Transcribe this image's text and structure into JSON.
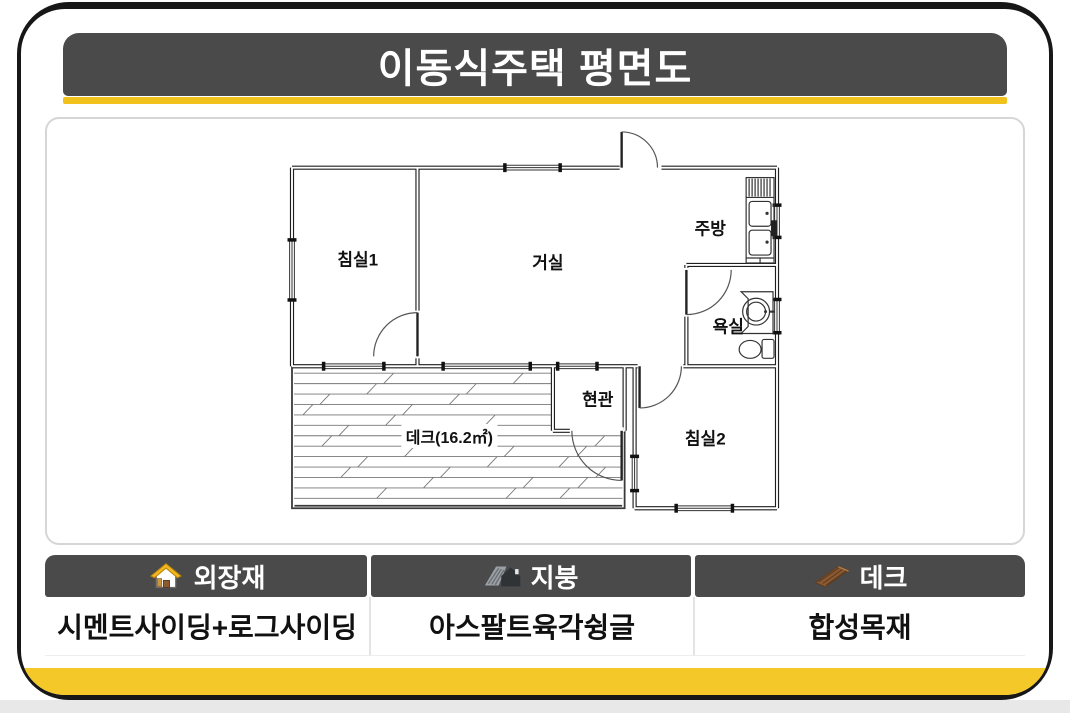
{
  "title": "이동식주택 평면도",
  "floor_plan": {
    "rooms": [
      {
        "id": "bedroom1",
        "name": "침실1",
        "x": 357,
        "y": 258,
        "bg": false
      },
      {
        "id": "living-room",
        "name": "거실",
        "x": 548,
        "y": 261,
        "bg": false
      },
      {
        "id": "kitchen",
        "name": "주방",
        "x": 711,
        "y": 227,
        "bg": false
      },
      {
        "id": "bathroom",
        "name": "욕실",
        "x": 729,
        "y": 325,
        "bg": false
      },
      {
        "id": "entrance",
        "name": "현관",
        "x": 598,
        "y": 399,
        "bg": false
      },
      {
        "id": "bedroom2",
        "name": "침실2",
        "x": 706,
        "y": 438,
        "bg": false
      },
      {
        "id": "deck",
        "name": "데크(16.2㎡)",
        "x": 449,
        "y": 437,
        "bg": true
      }
    ],
    "deck_area_m2": "16.2"
  },
  "spec_table": {
    "columns": [
      {
        "icon": "house-icon",
        "header": "외장재",
        "value": "시멘트사이딩+로그사이딩"
      },
      {
        "icon": "roof-icon",
        "header": "지붕",
        "value": "아스팔트육각슁글"
      },
      {
        "icon": "deck-icon",
        "header": "데크",
        "value": "합성목재"
      }
    ]
  },
  "colors": {
    "accent_yellow": "#F2C21C",
    "bottom_yellow": "#F5C829",
    "header_gray": "#4A4A4A",
    "frame_black": "#171717"
  }
}
